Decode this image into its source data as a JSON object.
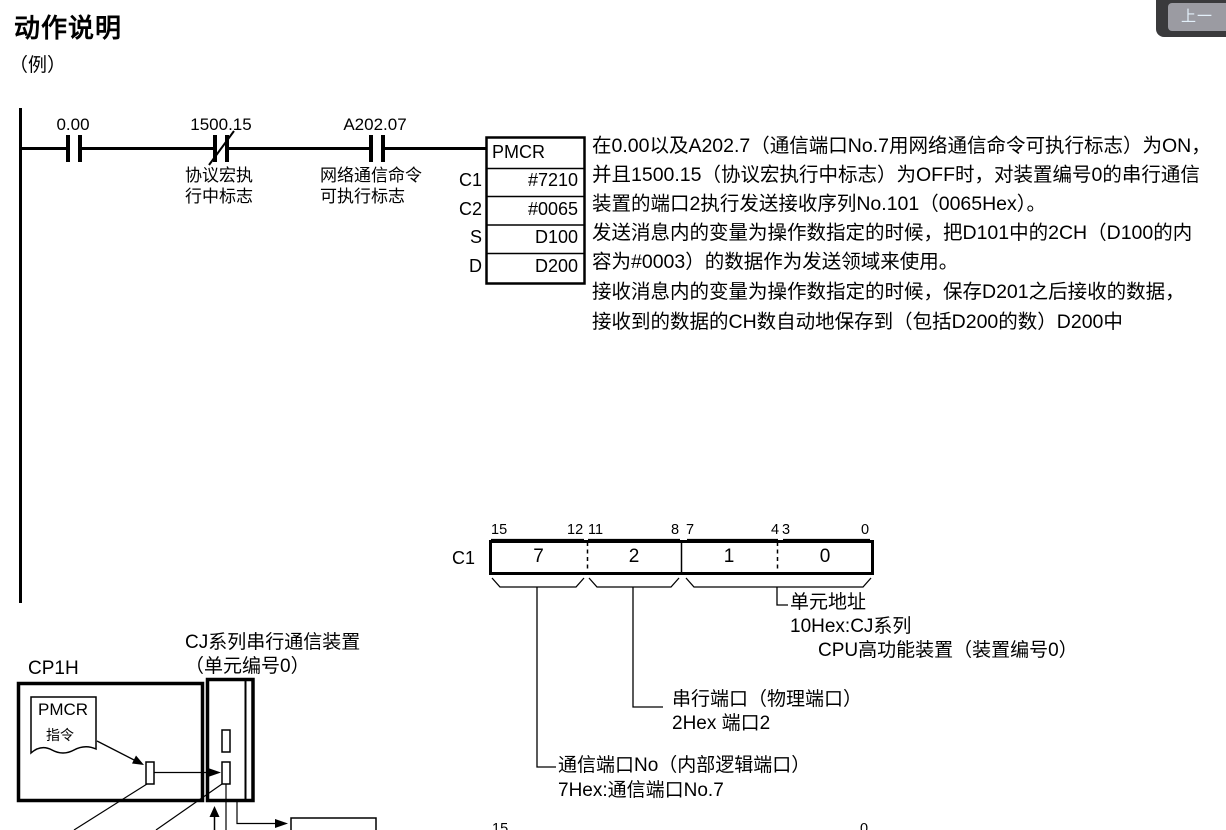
{
  "header": {
    "title": "动作说明",
    "example_label": "（例）"
  },
  "nav": {
    "prev_button_label": "上一"
  },
  "ladder": {
    "contact1_address": "0.00",
    "contact2_address": "1500.15",
    "contact2_label1": "协议宏执",
    "contact2_label2": "行中标志",
    "contact3_address": "A202.07",
    "contact3_label1": "网络通信命令",
    "contact3_label2": "可执行标志",
    "instruction": "PMCR",
    "operands": [
      {
        "name": "C1",
        "value": "#7210"
      },
      {
        "name": "C2",
        "value": "#0065"
      },
      {
        "name": "S",
        "value": "D100"
      },
      {
        "name": "D",
        "value": "D200"
      }
    ]
  },
  "description": {
    "lines": [
      "在0.00以及A202.7（通信端口No.7用网络通信命令可执行标志）为ON，",
      "并且1500.15（协议宏执行中标志）为OFF时，对装置编号0的串行通信",
      "装置的端口2执行发送接收序列No.101（0065Hex）。",
      "发送消息内的变量为操作数指定的时候，把D101中的2CH（D100的内",
      "容为#0003）的数据作为发送领域来使用。",
      "接收消息内的变量为操作数指定的时候，保存D201之后接收的数据，",
      "接收到的数据的CH数自动地保存到（包括D200的数）D200中"
    ]
  },
  "c1_bitfield": {
    "register": "C1",
    "bit_numbers": [
      "15",
      "12",
      "11",
      "8",
      "7",
      "4",
      "3",
      "0"
    ],
    "nibbles": [
      "7",
      "2",
      "1",
      "0"
    ],
    "callout_unit_address_1": "单元地址",
    "callout_unit_address_2": "10Hex:CJ系列",
    "callout_unit_address_3": "CPU高功能装置（装置编号0）",
    "callout_serial_port_1": "串行端口（物理端口）",
    "callout_serial_port_2": "2Hex 端口2",
    "callout_comm_port_1": "通信端口No（内部逻辑端口）",
    "callout_comm_port_2": "7Hex:通信端口No.7"
  },
  "device_diagram": {
    "cpu_label": "CP1H",
    "unit_label1": "CJ系列串行通信装置",
    "unit_label2": "（单元编号0）",
    "doc_label1": "PMCR",
    "doc_label2": "指令"
  },
  "c2_bitfield": {
    "bit_left": "15",
    "bit_right": "0"
  }
}
